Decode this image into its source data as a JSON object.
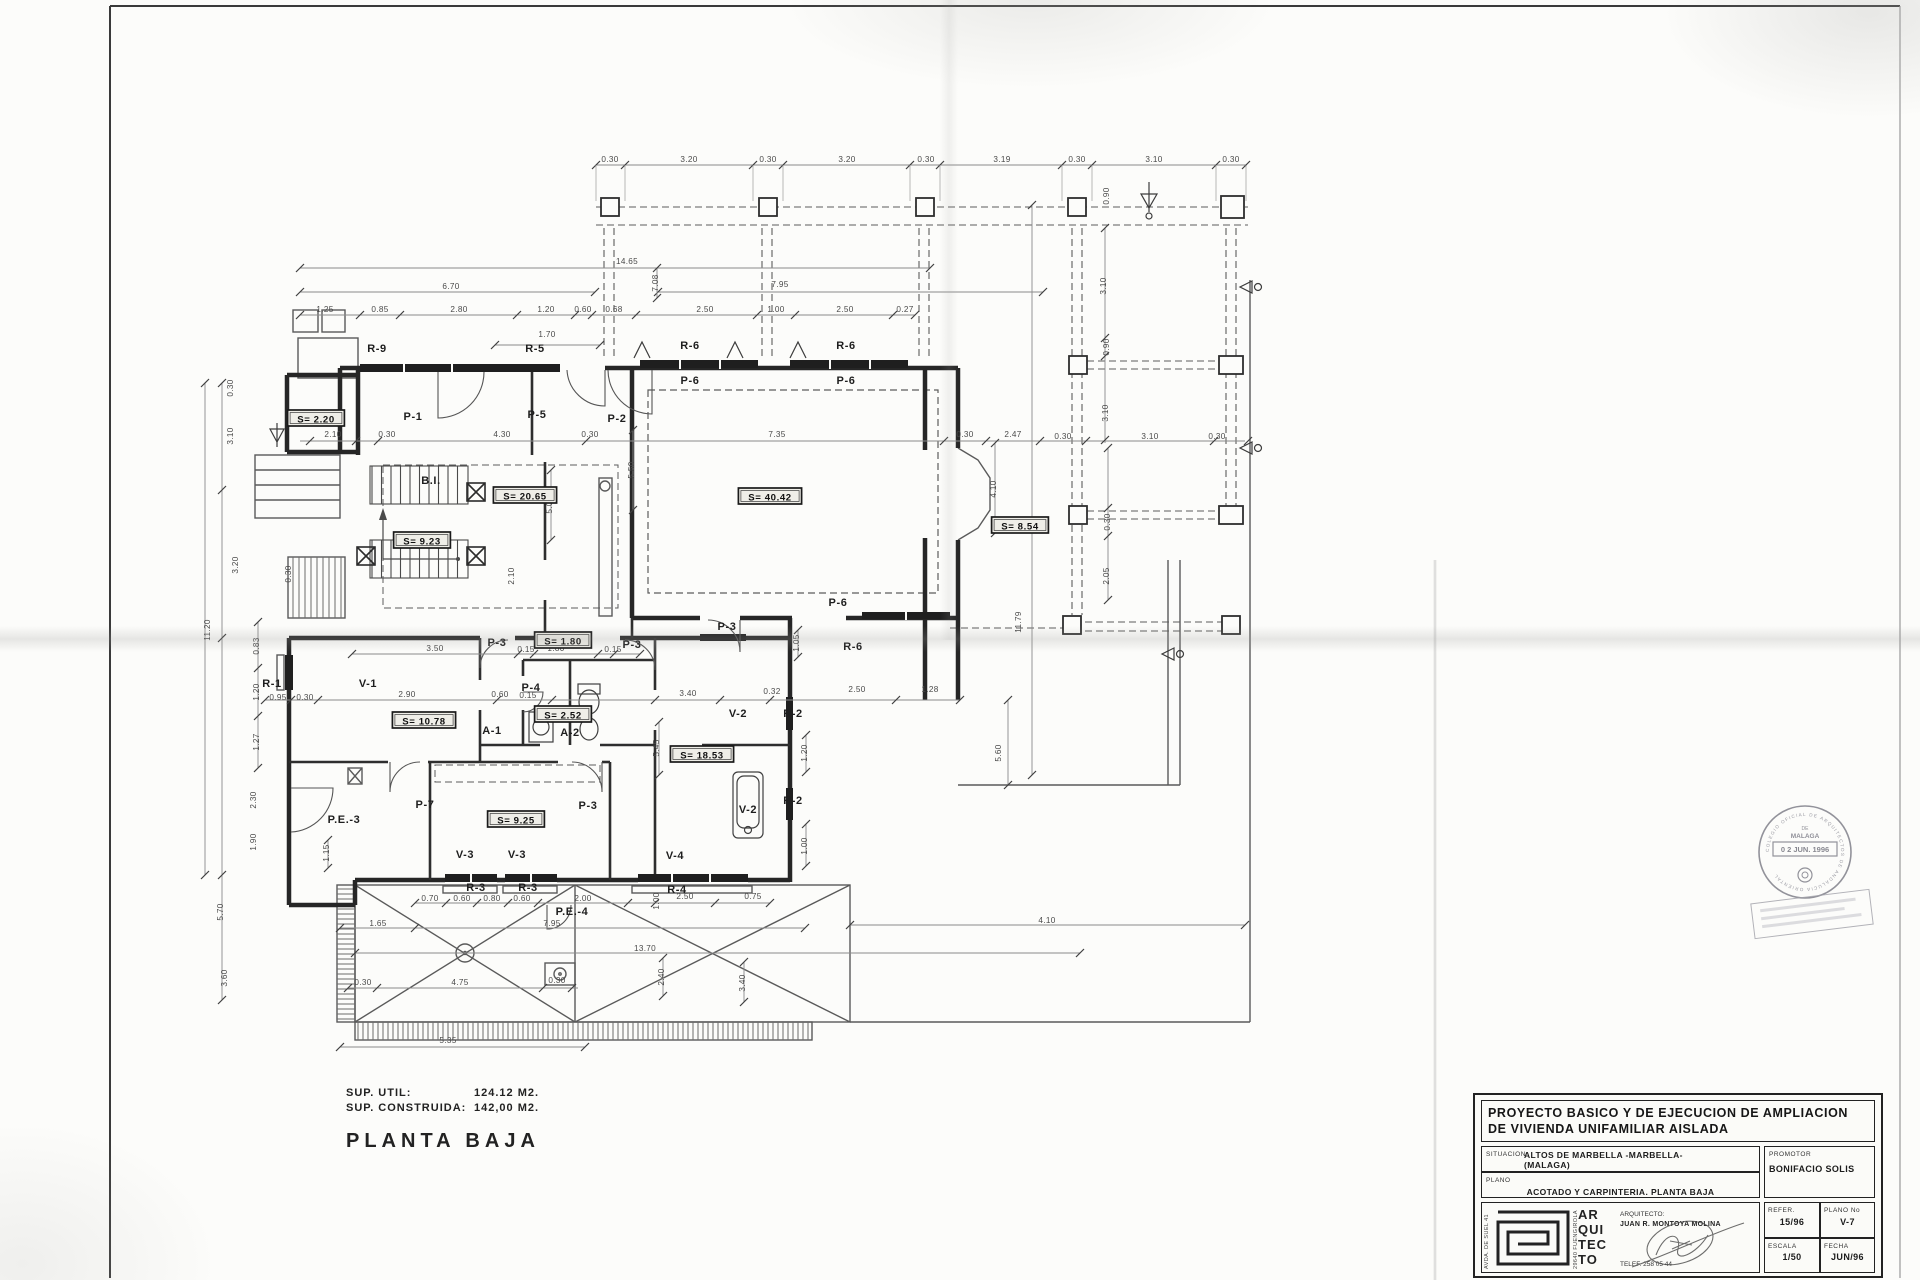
{
  "footer": {
    "sup_util_label": "SUP. UTIL:",
    "sup_util_value": "124.12 M2.",
    "sup_construida_label": "SUP. CONSTRUIDA:",
    "sup_construida_value": "142,00 M2.",
    "plan_title": "PLANTA BAJA"
  },
  "title_block": {
    "project_title_line1": "PROYECTO BASICO Y DE EJECUCION DE AMPLIACION",
    "project_title_line2": "DE VIVIENDA UNIFAMILIAR AISLADA",
    "situacion_label": "SITUACION",
    "situacion_value_line1": "ALTOS DE MARBELLA -MARBELLA-",
    "situacion_value_line2": "(MALAGA)",
    "plano_label": "PLANO",
    "plano_value": "ACOTADO Y CARPINTERIA. PLANTA BAJA",
    "promotor_label": "PROMOTOR",
    "promotor_value": "BONIFACIO SOLIS",
    "arquitecto_label": "ARQUITECTO:",
    "arquitecto_value": "JUAN R. MONTOYA MOLINA",
    "telefono": "TELEF. 258 05 44",
    "logo_word_1": "AR",
    "logo_word_2": "QUI",
    "logo_word_3": "TEC",
    "logo_word_4": "TO",
    "address_left": "AVDA. DE SUEL 41",
    "address_right": "29640 FUENGIROLA",
    "refer_label": "REFER.",
    "refer_value": "15/96",
    "plano_no_label": "PLANO No",
    "plano_no_value": "V-7",
    "escala_label": "ESCALA",
    "escala_value": "1/50",
    "fecha_label": "FECHA",
    "fecha_value": "JUN/96"
  },
  "stamp": {
    "arc_text": "COLEGIO OFICIAL DE ARQUITECTOS DE ANDALUCIA ORIENTAL",
    "line_de": "DE",
    "line_city": "MALAGA",
    "date": "0 2 JUN. 1996"
  },
  "floorplan": {
    "area_labels": [
      {
        "t": "S= 2.20",
        "x": 316,
        "y": 421
      },
      {
        "t": "S= 20.65",
        "x": 525,
        "y": 498
      },
      {
        "t": "S= 9.23",
        "x": 422,
        "y": 543
      },
      {
        "t": "S= 40.42",
        "x": 770,
        "y": 499
      },
      {
        "t": "S= 8.54",
        "x": 1020,
        "y": 528
      },
      {
        "t": "S= 1.80",
        "x": 563,
        "y": 643
      },
      {
        "t": "S= 10.78",
        "x": 424,
        "y": 723
      },
      {
        "t": "S= 2.52",
        "x": 563,
        "y": 717
      },
      {
        "t": "S= 18.53",
        "x": 702,
        "y": 757
      },
      {
        "t": "S= 9.25",
        "x": 516,
        "y": 822
      }
    ],
    "room_labels": [
      {
        "t": "R-9",
        "x": 377,
        "y": 352
      },
      {
        "t": "R-5",
        "x": 535,
        "y": 352
      },
      {
        "t": "P-1",
        "x": 413,
        "y": 420
      },
      {
        "t": "P-5",
        "x": 537,
        "y": 418
      },
      {
        "t": "P-2",
        "x": 617,
        "y": 422
      },
      {
        "t": "R-6",
        "x": 690,
        "y": 349
      },
      {
        "t": "R-6",
        "x": 846,
        "y": 349
      },
      {
        "t": "P-6",
        "x": 690,
        "y": 384
      },
      {
        "t": "P-6",
        "x": 846,
        "y": 384
      },
      {
        "t": "P-6",
        "x": 838,
        "y": 606
      },
      {
        "t": "P-3",
        "x": 727,
        "y": 630
      },
      {
        "t": "R-6",
        "x": 853,
        "y": 650
      },
      {
        "t": "B.I.",
        "x": 431,
        "y": 484
      },
      {
        "t": "B.I.",
        "x": 431,
        "y": 546
      },
      {
        "t": "R-1",
        "x": 272,
        "y": 687
      },
      {
        "t": "V-1",
        "x": 368,
        "y": 687
      },
      {
        "t": "P-3",
        "x": 497,
        "y": 646
      },
      {
        "t": "P-3",
        "x": 632,
        "y": 648
      },
      {
        "t": "P-4",
        "x": 531,
        "y": 691
      },
      {
        "t": "A-1",
        "x": 492,
        "y": 734
      },
      {
        "t": "A-2",
        "x": 570,
        "y": 736
      },
      {
        "t": "V-2",
        "x": 738,
        "y": 717
      },
      {
        "t": "R-2",
        "x": 793,
        "y": 717
      },
      {
        "t": "R-2",
        "x": 793,
        "y": 804
      },
      {
        "t": "V-2",
        "x": 748,
        "y": 813
      },
      {
        "t": "P-7",
        "x": 425,
        "y": 808
      },
      {
        "t": "P-3",
        "x": 588,
        "y": 809
      },
      {
        "t": "P.E.-3",
        "x": 344,
        "y": 823
      },
      {
        "t": "V-3",
        "x": 465,
        "y": 858
      },
      {
        "t": "V-3",
        "x": 517,
        "y": 858
      },
      {
        "t": "V-4",
        "x": 675,
        "y": 859
      },
      {
        "t": "R-3",
        "x": 476,
        "y": 891
      },
      {
        "t": "R-3",
        "x": 528,
        "y": 891
      },
      {
        "t": "R-4",
        "x": 677,
        "y": 893
      },
      {
        "t": "P.E.-4",
        "x": 572,
        "y": 915
      }
    ],
    "dims_h": [
      {
        "t": "0.30",
        "x": 610,
        "y": 162
      },
      {
        "t": "3.20",
        "x": 689,
        "y": 162
      },
      {
        "t": "0.30",
        "x": 768,
        "y": 162
      },
      {
        "t": "3.20",
        "x": 847,
        "y": 162
      },
      {
        "t": "0.30",
        "x": 926,
        "y": 162
      },
      {
        "t": "3.19",
        "x": 1002,
        "y": 162
      },
      {
        "t": "0.30",
        "x": 1077,
        "y": 162
      },
      {
        "t": "3.10",
        "x": 1154,
        "y": 162
      },
      {
        "t": "0.30",
        "x": 1231,
        "y": 162
      },
      {
        "t": "14.65",
        "x": 627,
        "y": 264
      },
      {
        "t": "6.70",
        "x": 451,
        "y": 289
      },
      {
        "t": "7.95",
        "x": 780,
        "y": 287
      },
      {
        "t": "1.25",
        "x": 325,
        "y": 312
      },
      {
        "t": "0.85",
        "x": 380,
        "y": 312
      },
      {
        "t": "2.80",
        "x": 459,
        "y": 312
      },
      {
        "t": "1.20",
        "x": 546,
        "y": 312
      },
      {
        "t": "0.60",
        "x": 583,
        "y": 312
      },
      {
        "t": "0.68",
        "x": 614,
        "y": 312
      },
      {
        "t": "2.50",
        "x": 705,
        "y": 312
      },
      {
        "t": "1.00",
        "x": 776,
        "y": 312
      },
      {
        "t": "2.50",
        "x": 845,
        "y": 312
      },
      {
        "t": "0.27",
        "x": 905,
        "y": 312
      },
      {
        "t": "1.70",
        "x": 547,
        "y": 337
      },
      {
        "t": "2.10",
        "x": 333,
        "y": 437
      },
      {
        "t": "0.30",
        "x": 387,
        "y": 437
      },
      {
        "t": "4.30",
        "x": 502,
        "y": 437
      },
      {
        "t": "0.30",
        "x": 590,
        "y": 437
      },
      {
        "t": "7.35",
        "x": 777,
        "y": 437
      },
      {
        "t": "0.30",
        "x": 965,
        "y": 437
      },
      {
        "t": "2.47",
        "x": 1013,
        "y": 437
      },
      {
        "t": "0.30",
        "x": 1063,
        "y": 439
      },
      {
        "t": "3.10",
        "x": 1150,
        "y": 439
      },
      {
        "t": "0.30",
        "x": 1217,
        "y": 439
      },
      {
        "t": "3.50",
        "x": 435,
        "y": 651
      },
      {
        "t": "0.15",
        "x": 526,
        "y": 652
      },
      {
        "t": "1.80",
        "x": 556,
        "y": 651
      },
      {
        "t": "0.15",
        "x": 613,
        "y": 652
      },
      {
        "t": "0.95",
        "x": 278,
        "y": 700
      },
      {
        "t": "0.30",
        "x": 305,
        "y": 700
      },
      {
        "t": "2.90",
        "x": 407,
        "y": 697
      },
      {
        "t": "0.60",
        "x": 500,
        "y": 697
      },
      {
        "t": "0.15",
        "x": 528,
        "y": 698
      },
      {
        "t": "3.40",
        "x": 688,
        "y": 696
      },
      {
        "t": "0.32",
        "x": 772,
        "y": 694
      },
      {
        "t": "2.50",
        "x": 857,
        "y": 692
      },
      {
        "t": "1.28",
        "x": 930,
        "y": 692
      },
      {
        "t": "0.70",
        "x": 430,
        "y": 901
      },
      {
        "t": "0.60",
        "x": 462,
        "y": 901
      },
      {
        "t": "0.80",
        "x": 492,
        "y": 901
      },
      {
        "t": "0.60",
        "x": 522,
        "y": 901
      },
      {
        "t": "2.00",
        "x": 583,
        "y": 901
      },
      {
        "t": "2.50",
        "x": 685,
        "y": 899
      },
      {
        "t": "0.75",
        "x": 753,
        "y": 899
      },
      {
        "t": "1.65",
        "x": 378,
        "y": 926
      },
      {
        "t": "7.95",
        "x": 552,
        "y": 926
      },
      {
        "t": "4.10",
        "x": 1047,
        "y": 923
      },
      {
        "t": "13.70",
        "x": 645,
        "y": 951
      },
      {
        "t": "0.30",
        "x": 363,
        "y": 985
      },
      {
        "t": "4.75",
        "x": 460,
        "y": 985
      },
      {
        "t": "0.30",
        "x": 557,
        "y": 983
      },
      {
        "t": "5.35",
        "x": 448,
        "y": 1043
      }
    ],
    "dims_v": [
      {
        "t": "0.30",
        "x": 233,
        "y": 388
      },
      {
        "t": "3.10",
        "x": 233,
        "y": 436
      },
      {
        "t": "3.20",
        "x": 238,
        "y": 565
      },
      {
        "t": "11.20",
        "x": 210,
        "y": 630
      },
      {
        "t": "0.83",
        "x": 259,
        "y": 646
      },
      {
        "t": "1.20",
        "x": 259,
        "y": 692
      },
      {
        "t": "1.27",
        "x": 259,
        "y": 742
      },
      {
        "t": "2.30",
        "x": 256,
        "y": 800
      },
      {
        "t": "1.90",
        "x": 256,
        "y": 842
      },
      {
        "t": "5.70",
        "x": 223,
        "y": 912
      },
      {
        "t": "3.60",
        "x": 227,
        "y": 978
      },
      {
        "t": "1.15",
        "x": 329,
        "y": 853
      },
      {
        "t": "0.30",
        "x": 291,
        "y": 574
      },
      {
        "t": "2.10",
        "x": 514,
        "y": 576
      },
      {
        "t": "5.00",
        "x": 552,
        "y": 505
      },
      {
        "t": "5.50",
        "x": 634,
        "y": 470
      },
      {
        "t": "7.08",
        "x": 658,
        "y": 283
      },
      {
        "t": "5.45",
        "x": 659,
        "y": 748
      },
      {
        "t": "1.05",
        "x": 799,
        "y": 643
      },
      {
        "t": "1.20",
        "x": 807,
        "y": 753
      },
      {
        "t": "1.00",
        "x": 807,
        "y": 846
      },
      {
        "t": "4.10",
        "x": 996,
        "y": 489
      },
      {
        "t": "5.60",
        "x": 1001,
        "y": 753
      },
      {
        "t": "11.79",
        "x": 1021,
        "y": 622
      },
      {
        "t": "0.90",
        "x": 1109,
        "y": 196
      },
      {
        "t": "3.10",
        "x": 1106,
        "y": 286
      },
      {
        "t": "0.90",
        "x": 1109,
        "y": 347
      },
      {
        "t": "3.10",
        "x": 1108,
        "y": 413
      },
      {
        "t": "0.30",
        "x": 1110,
        "y": 522
      },
      {
        "t": "2.05",
        "x": 1109,
        "y": 576
      },
      {
        "t": "2.40",
        "x": 664,
        "y": 977
      },
      {
        "t": "3.40",
        "x": 745,
        "y": 983
      },
      {
        "t": "1.00",
        "x": 659,
        "y": 901
      }
    ]
  }
}
